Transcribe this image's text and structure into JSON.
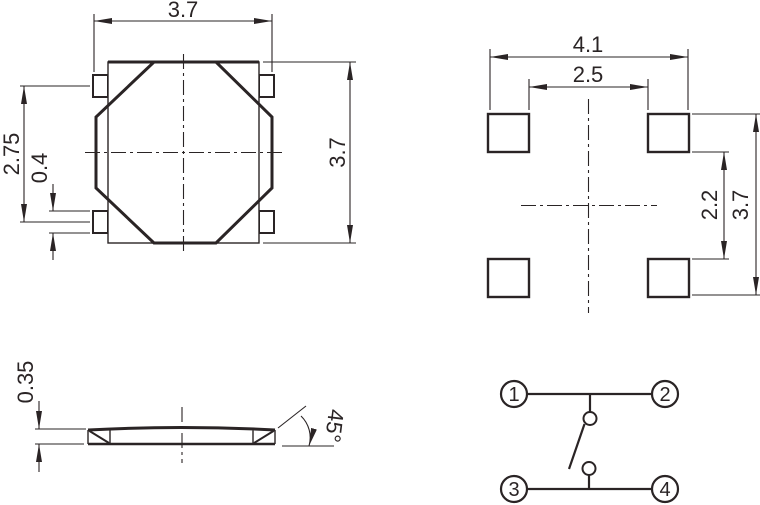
{
  "colors": {
    "line": "#2a2425",
    "background": "#ffffff"
  },
  "views": {
    "top_view": {
      "dim_width": "3.7",
      "dim_height": "3.7",
      "dim_pad_center_span": "2.75",
      "dim_pad_width": "0.4"
    },
    "land_pattern_view": {
      "dim_outer_width": "4.1",
      "dim_inner_span_x": "2.5",
      "dim_inner_span_y": "2.2",
      "dim_outer_height": "3.7"
    },
    "side_view": {
      "dim_thickness": "0.35",
      "dim_edge_angle": "45°"
    },
    "schematic_view": {
      "pins": [
        "1",
        "2",
        "3",
        "4"
      ]
    }
  }
}
